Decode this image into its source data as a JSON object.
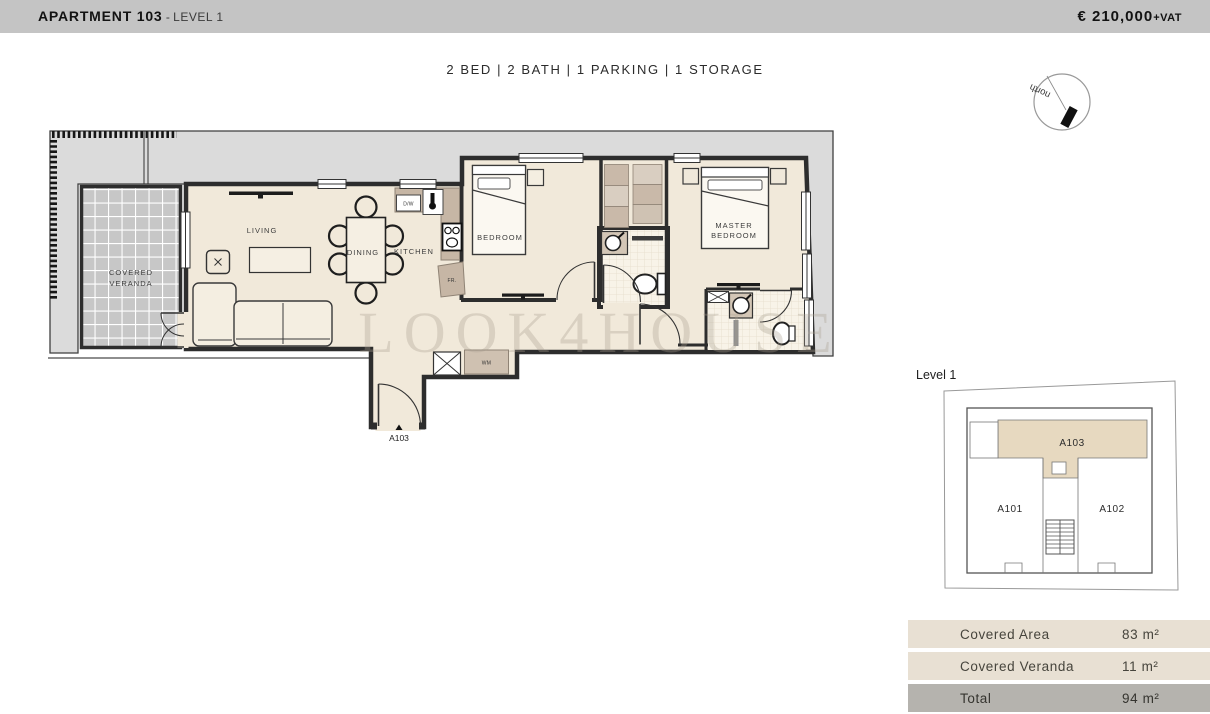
{
  "header": {
    "title": "APARTMENT 103",
    "separator": " - ",
    "level": "LEVEL 1",
    "price": "€ 210,000",
    "vat": "+VAT"
  },
  "summary": "2 BED | 2 BATH | 1 PARKING | 1 STORAGE",
  "compass": {
    "label": "north"
  },
  "plan": {
    "rooms": {
      "living": "LIVING",
      "dining": "DINING",
      "kitchen": "KITCHEN",
      "bedroom": "BEDROOM",
      "master_line1": "MASTER",
      "master_line2": "BEDROOM",
      "veranda_line1": "COVERED",
      "veranda_line2": "VERANDA"
    },
    "tags": {
      "dishwasher": "D/W",
      "fridge": "FR.",
      "washing_machine": "WM",
      "entry_door": "A103"
    },
    "watermark": "LOOK4HOUSE"
  },
  "keyplan": {
    "title": "Level 1",
    "units": {
      "a101": "A101",
      "a102": "A102",
      "a103": "A103"
    }
  },
  "areas_table": {
    "rows": [
      {
        "label": "Covered Area",
        "value": "83 m²"
      },
      {
        "label": "Covered Veranda",
        "value": "11 m²"
      },
      {
        "label": "Total",
        "value": "94 m²"
      }
    ]
  },
  "colors": {
    "header_bg": "#c4c4c4",
    "wall": "#2d2d2d",
    "floor_beige": "#f1e9da",
    "terrace_gray": "#dbdbdb",
    "veranda_tile": "#c7c7c7",
    "counter_tan": "#c6b6a5",
    "wardrobe_dark": "#c9b9a9",
    "wardrobe_light": "#d9cec1",
    "bath_tile": "#f8f3e8",
    "keyplan_unit_fill": "#e7d9c0",
    "table_row_bg": "#e8e0d3",
    "table_total_bg": "#b5b3ae"
  }
}
